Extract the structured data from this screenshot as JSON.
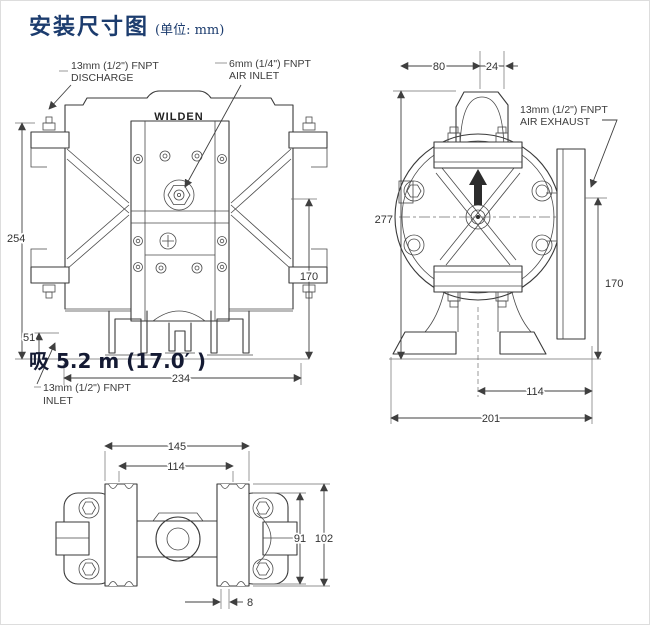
{
  "title": {
    "text": "安装尺寸图",
    "unit_note": "(单位: mm)"
  },
  "front_view": {
    "brand": "WILDEN",
    "labels": {
      "discharge_line1": "13mm (1/2\") FNPT",
      "discharge_line2": "DISCHARGE",
      "air_inlet_line1": "6mm (1/4\") FNPT",
      "air_inlet_line2": "AIR INLET",
      "inlet_line1": "13mm (1/2\") FNPT",
      "inlet_line2": "INLET"
    },
    "overlay_text": "吸 5.2 m (17.0′ )",
    "dims": {
      "overall_height": "254",
      "foot_height": "51",
      "port_height": "170",
      "overall_width": "234"
    }
  },
  "side_view": {
    "labels": {
      "air_exhaust_line1": "13mm (1/2\") FNPT",
      "air_exhaust_line2": "AIR EXHAUST"
    },
    "dims": {
      "muffler_offset": "80",
      "muffler_width": "24",
      "overall_height": "277",
      "exhaust_height": "170",
      "foot_span": "114",
      "overall_width": "201"
    }
  },
  "top_view": {
    "dims": {
      "foot_outer_width": "145",
      "bolt_span": "114",
      "body_depth": "91",
      "overall_depth": "102",
      "slot_width": "8"
    }
  }
}
